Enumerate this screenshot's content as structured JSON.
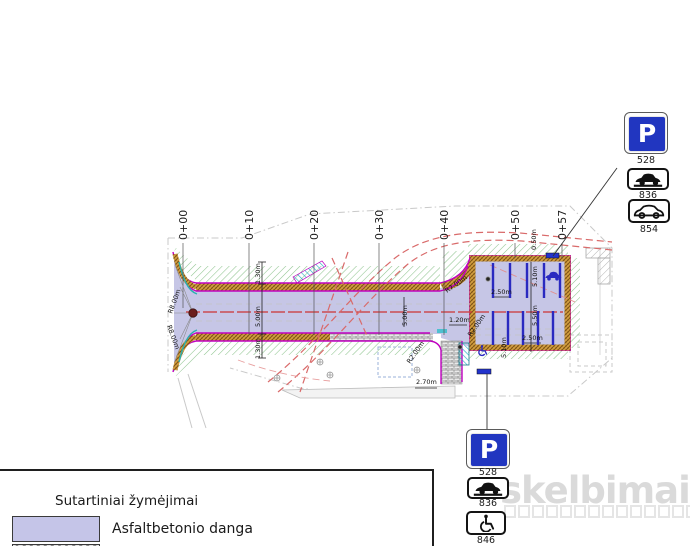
{
  "plan": {
    "stations": [
      "0+00",
      "0+10",
      "0+20",
      "0+30",
      "0+40",
      "0+50",
      "0+57"
    ],
    "dims": [
      "1.30m",
      "5.00m",
      "1.30m",
      "5.00m",
      "1.20m",
      "R7.00m",
      "R2.00m",
      "R2.00m",
      "2.70m",
      "R8.00m",
      "R8.00m",
      "2.50m",
      "5.10m",
      "5.50m",
      "2.50m",
      "5.10m",
      "0.50m"
    ]
  },
  "signs": {
    "right": {
      "parking_letter": "P",
      "parking_code": "528",
      "tab1_code": "836",
      "tab2_code": "854"
    },
    "bottom": {
      "parking_letter": "P",
      "parking_code": "528",
      "tab1_code": "836",
      "tab2_code": "846"
    }
  },
  "legend": {
    "title": "Sutartiniai žymėjimai",
    "items": [
      {
        "label": "Asfaltbetonio danga"
      }
    ]
  },
  "watermark": {
    "text": "skelbimai.lt"
  },
  "colors": {
    "asphalt": "#c6c6e6",
    "edge_magenta": "#c000c0",
    "shoulder_tan": "#d6a344",
    "hatch_green": "#8fc48f",
    "centerline_red": "#cc3333",
    "bay_blue": "#2a2ac0",
    "sign_blue": "#2136c0"
  }
}
